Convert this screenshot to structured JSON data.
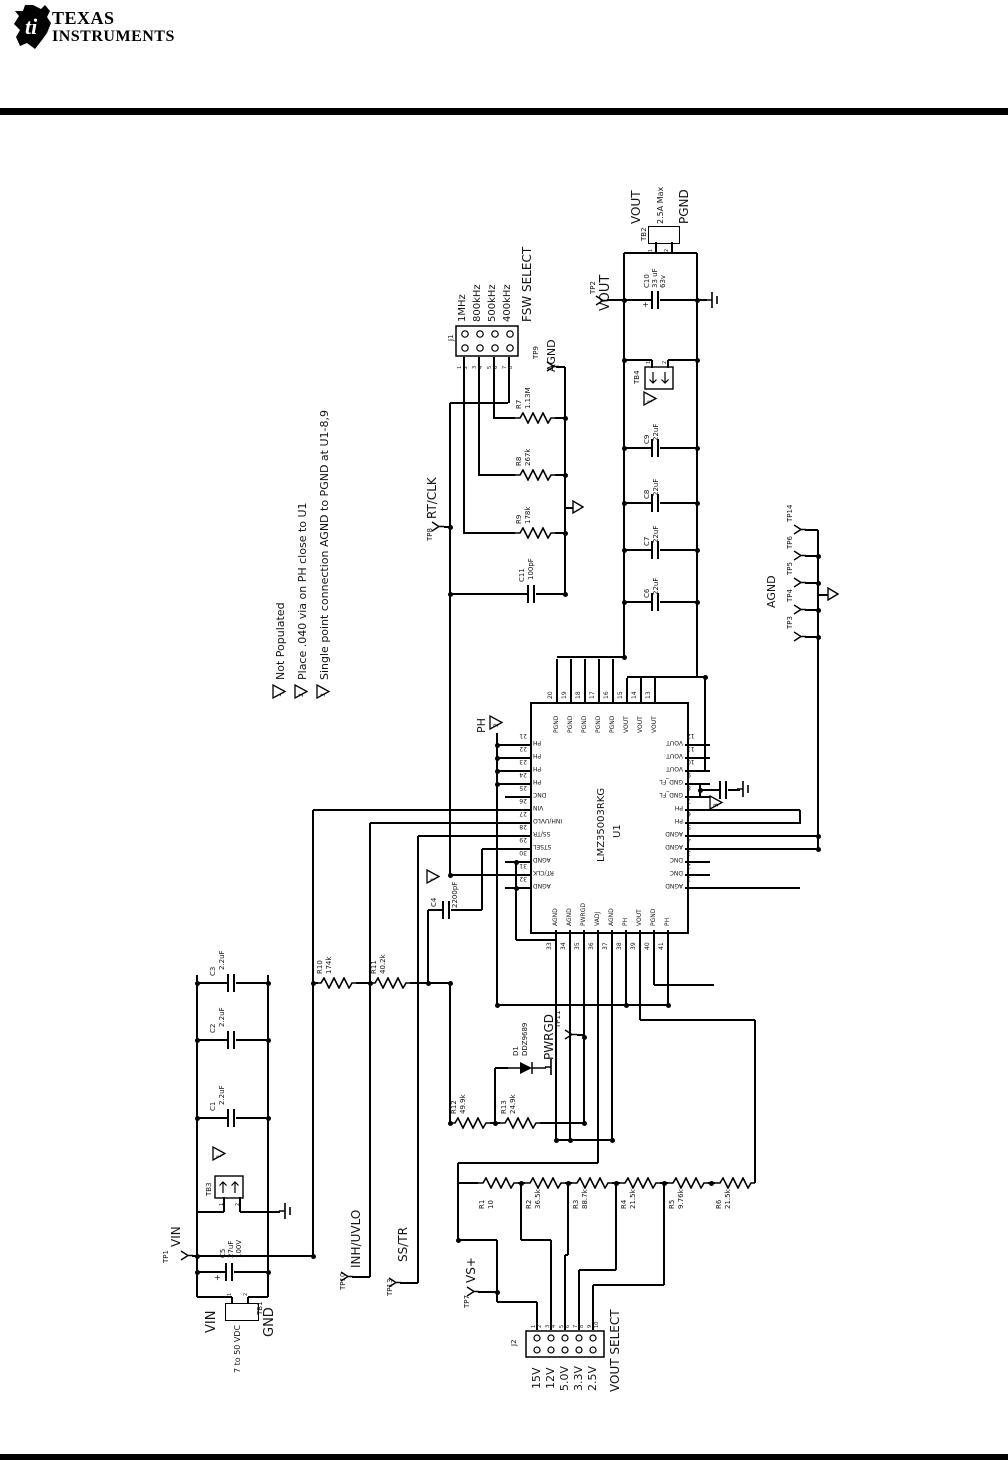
{
  "header": {
    "brand_line1": "TEXAS",
    "brand_line2": "INSTRUMENTS",
    "logo_mark": "ti"
  },
  "notes": [
    {
      "num": "1",
      "text": "Not Populated"
    },
    {
      "num": "2",
      "text": "Place .040 via on PH close to U1"
    },
    {
      "num": "3",
      "text": "Single point connection AGND to PGND at U1-8,9"
    }
  ],
  "labels": {
    "agnd": "AGND",
    "ph": "PH"
  },
  "symbols": {
    "plus": "+"
  },
  "ic": {
    "ref": "U1",
    "part": "LMZ35003RKG",
    "top_pins": [
      {
        "num": "20",
        "name": "PGND"
      },
      {
        "num": "19",
        "name": "PGND"
      },
      {
        "num": "18",
        "name": "PGND"
      },
      {
        "num": "17",
        "name": "PGND"
      },
      {
        "num": "16",
        "name": "PGND"
      },
      {
        "num": "15",
        "name": "VOUT"
      },
      {
        "num": "14",
        "name": "VOUT"
      },
      {
        "num": "13",
        "name": "VOUT"
      }
    ],
    "left_pins": [
      {
        "num": "21",
        "name": "PH"
      },
      {
        "num": "22",
        "name": "PH"
      },
      {
        "num": "23",
        "name": "PH"
      },
      {
        "num": "24",
        "name": "PH"
      },
      {
        "num": "25",
        "name": "DNC"
      },
      {
        "num": "26",
        "name": "VIN"
      },
      {
        "num": "27",
        "name": "INH/UVLO"
      },
      {
        "num": "28",
        "name": "SS/TR"
      },
      {
        "num": "29",
        "name": "STSEL"
      },
      {
        "num": "30",
        "name": "AGND"
      },
      {
        "num": "31",
        "name": "RT/CLK"
      },
      {
        "num": "32",
        "name": "AGND"
      }
    ],
    "right_pins": [
      {
        "num": "12",
        "name": "VOUT"
      },
      {
        "num": "11",
        "name": "VOUT"
      },
      {
        "num": "10",
        "name": "VOUT"
      },
      {
        "num": "9",
        "name": "GND_FL"
      },
      {
        "num": "8",
        "name": "GND_FL"
      },
      {
        "num": "7",
        "name": "PH"
      },
      {
        "num": "6",
        "name": "PH"
      },
      {
        "num": "5",
        "name": "AGND"
      },
      {
        "num": "4",
        "name": "AGND"
      },
      {
        "num": "3",
        "name": "DNC"
      },
      {
        "num": "2",
        "name": "DNC"
      },
      {
        "num": "1",
        "name": "AGND"
      }
    ],
    "bottom_pins": [
      {
        "num": "33",
        "name": "AGND"
      },
      {
        "num": "34",
        "name": "AGND"
      },
      {
        "num": "35",
        "name": "PWRGD"
      },
      {
        "num": "36",
        "name": "VADJ"
      },
      {
        "num": "37",
        "name": "AGND"
      },
      {
        "num": "38",
        "name": "PH"
      },
      {
        "num": "39",
        "name": "VOUT"
      },
      {
        "num": "40",
        "name": "PGND"
      },
      {
        "num": "41",
        "name": "PH"
      }
    ]
  },
  "connectors": {
    "j1": {
      "ref": "J1",
      "title": "FSW SELECT",
      "options": [
        "1MHz",
        "800kHz",
        "500kHz",
        "400kHz"
      ],
      "pins": [
        "1",
        "2",
        "3",
        "4",
        "5",
        "6",
        "7",
        "8"
      ]
    },
    "j2": {
      "ref": "J2",
      "title": "VOUT SELECT",
      "options": [
        "15V",
        "12V",
        "5.0V",
        "3.3V",
        "2.5V"
      ],
      "pins": [
        "1",
        "2",
        "3",
        "4",
        "5",
        "6",
        "7",
        "8",
        "9",
        "10"
      ]
    },
    "tb1": {
      "ref": "TB1",
      "pos": "VIN",
      "range": "7 to 50 VDC",
      "neg": "GND",
      "pins": [
        "1",
        "2"
      ]
    },
    "tb2": {
      "ref": "TB2",
      "pos": "VOUT",
      "current": "2.5A Max",
      "neg": "PGND",
      "pins": [
        "1",
        "2"
      ]
    },
    "tb3": {
      "ref": "TB3",
      "pins": [
        "1",
        "2"
      ]
    },
    "tb4": {
      "ref": "TB4",
      "pins": [
        "1",
        "2"
      ]
    }
  },
  "resistors": [
    {
      "ref": "R1",
      "value": "10"
    },
    {
      "ref": "R2",
      "value": "36.5k"
    },
    {
      "ref": "R3",
      "value": "88.7k"
    },
    {
      "ref": "R4",
      "value": "21.5k"
    },
    {
      "ref": "R5",
      "value": "9.76k"
    },
    {
      "ref": "R6",
      "value": "21.5k"
    },
    {
      "ref": "R7",
      "value": "1.13M"
    },
    {
      "ref": "R8",
      "value": "267k"
    },
    {
      "ref": "R9",
      "value": "178k"
    },
    {
      "ref": "R10",
      "value": "174k"
    },
    {
      "ref": "R11",
      "value": "40.2k"
    },
    {
      "ref": "R12",
      "value": "49.9k"
    },
    {
      "ref": "R13",
      "value": "24.9k"
    }
  ],
  "capacitors": [
    {
      "ref": "C1",
      "value": "2.2uF"
    },
    {
      "ref": "C2",
      "value": "2.2uF"
    },
    {
      "ref": "C3",
      "value": "2.2uF"
    },
    {
      "ref": "C4",
      "value": "2200pF"
    },
    {
      "ref": "C5",
      "value": "27uF",
      "voltage": "100V"
    },
    {
      "ref": "C6",
      "value": "22uF"
    },
    {
      "ref": "C7",
      "value": "22uF"
    },
    {
      "ref": "C8",
      "value": "22uF"
    },
    {
      "ref": "C9",
      "value": "22uF"
    },
    {
      "ref": "C10",
      "value": "33 uF",
      "voltage": "63v"
    },
    {
      "ref": "C11",
      "value": "100pF"
    }
  ],
  "diode": {
    "ref": "D1",
    "part": "DDZ9689"
  },
  "testpoints": [
    {
      "ref": "TP1",
      "net": "VIN"
    },
    {
      "ref": "TP2",
      "net": "VOUT"
    },
    {
      "ref": "TP3",
      "net": ""
    },
    {
      "ref": "TP4",
      "net": ""
    },
    {
      "ref": "TP5",
      "net": ""
    },
    {
      "ref": "TP6",
      "net": ""
    },
    {
      "ref": "TP14",
      "net": ""
    },
    {
      "ref": "TP7",
      "net": "VS+"
    },
    {
      "ref": "TP8",
      "net": "RT/CLK"
    },
    {
      "ref": "TP9",
      "net": "AGND"
    },
    {
      "ref": "TP10",
      "net": "INH/UVLO"
    },
    {
      "ref": "TP11",
      "net": "PWRGD"
    },
    {
      "ref": "TP13",
      "net": "SS/TR"
    }
  ]
}
